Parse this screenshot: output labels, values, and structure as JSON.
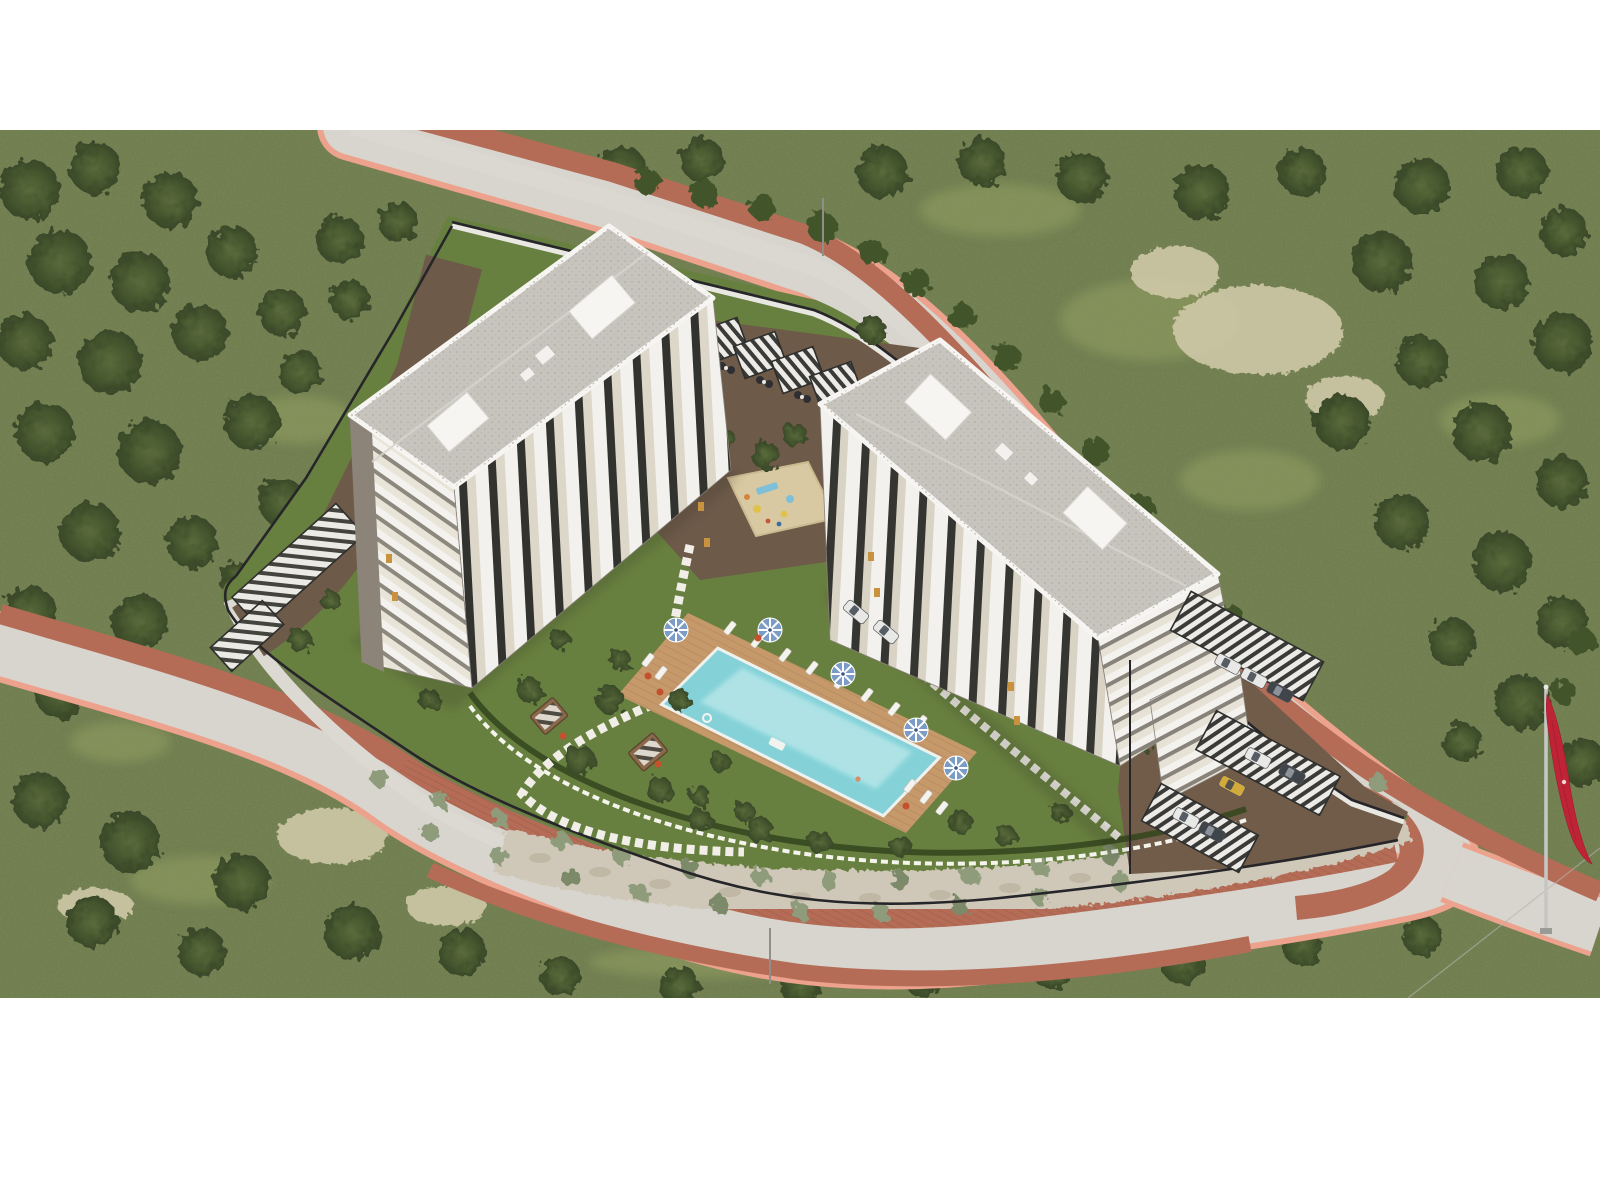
{
  "scene": {
    "kind": "aerial-architectural-render",
    "subject": "two-block residential complex with pool, gardens and parking on a forested hillside",
    "flag": "turkish-red-flag-on-pole",
    "render_area": {
      "top": 130,
      "bottom": 998,
      "left": 0,
      "right": 1600
    }
  },
  "palette": {
    "page_bg": "#ffffff",
    "forest_base": "#6d7b4b",
    "forest_noise": "#3d4a27",
    "grass_light": "#96a263",
    "rock": "#d4cbab",
    "road_surface": "#d8d4ce",
    "road_center": "#e3e0db",
    "sidewalk_salmon": "#eca28c",
    "sidewalk_brick": "#b46c56",
    "stone_band": "#cfc8b9",
    "stone_dot": "#bcb3a0",
    "wall_light": "#dcd9d2",
    "fence_black": "#26262a",
    "fence_white": "#f4f3ec",
    "lawn": "#68803f",
    "hedge": "#36471f",
    "tree_core": "#42552c",
    "mulch": "#6e5a49",
    "parking_dirt": "#705c49",
    "deck": "#c6996b",
    "deck_line": "#b2875c",
    "pool_water": "#84d2d8",
    "pool_light": "#bce8ea",
    "pool_coping": "#eff1ee",
    "sand": "#d9c9a2",
    "roof": "#c7c4be",
    "roof_dot": "#b2afa8",
    "parapet": "#f6f5f2",
    "facade_cream": "#e4dfd3",
    "facade_white": "#f3f1ed",
    "facade_dark": "#32322e",
    "facade_gray": "#8c8379",
    "window_amber": "#c8923f",
    "canopy_slat": "#ecebe7",
    "car_white": "#e8e8e6",
    "car_dark": "#40444b",
    "car_yellow": "#d2a93c",
    "umbrella_blue": "#7b9cc6",
    "flag_red": "#bf2336",
    "pole_gray": "#c6c6c3",
    "shadow": "#2b2b20"
  },
  "forest": {
    "canopies": [
      [
        30,
        190,
        30
      ],
      [
        95,
        168,
        26
      ],
      [
        170,
        200,
        28
      ],
      [
        60,
        262,
        32
      ],
      [
        140,
        282,
        30
      ],
      [
        232,
        252,
        26
      ],
      [
        25,
        342,
        28
      ],
      [
        110,
        362,
        32
      ],
      [
        200,
        332,
        28
      ],
      [
        282,
        312,
        24
      ],
      [
        45,
        432,
        30
      ],
      [
        150,
        452,
        32
      ],
      [
        252,
        422,
        28
      ],
      [
        90,
        532,
        30
      ],
      [
        192,
        542,
        26
      ],
      [
        282,
        502,
        24
      ],
      [
        30,
        612,
        26
      ],
      [
        140,
        622,
        28
      ],
      [
        242,
        582,
        22
      ],
      [
        60,
        692,
        26
      ],
      [
        162,
        702,
        24
      ],
      [
        40,
        800,
        28
      ],
      [
        130,
        842,
        30
      ],
      [
        242,
        882,
        28
      ],
      [
        352,
        932,
        28
      ],
      [
        92,
        922,
        26
      ],
      [
        462,
        952,
        24
      ],
      [
        202,
        952,
        24
      ],
      [
        560,
        976,
        20
      ],
      [
        680,
        986,
        20
      ],
      [
        800,
        986,
        20
      ],
      [
        922,
        976,
        20
      ],
      [
        1052,
        970,
        20
      ],
      [
        1182,
        962,
        22
      ],
      [
        1302,
        946,
        20
      ],
      [
        1422,
        936,
        20
      ],
      [
        520,
        166,
        24
      ],
      [
        622,
        172,
        26
      ],
      [
        702,
        160,
        22
      ],
      [
        882,
        172,
        26
      ],
      [
        982,
        162,
        24
      ],
      [
        1082,
        177,
        26
      ],
      [
        1202,
        192,
        28
      ],
      [
        1302,
        172,
        24
      ],
      [
        1422,
        186,
        28
      ],
      [
        1522,
        172,
        26
      ],
      [
        1564,
        232,
        24
      ],
      [
        1382,
        262,
        30
      ],
      [
        1502,
        282,
        28
      ],
      [
        1562,
        342,
        30
      ],
      [
        1422,
        362,
        26
      ],
      [
        1342,
        422,
        28
      ],
      [
        1482,
        432,
        30
      ],
      [
        1562,
        482,
        26
      ],
      [
        1402,
        522,
        28
      ],
      [
        1502,
        562,
        30
      ],
      [
        1562,
        622,
        26
      ],
      [
        1452,
        642,
        24
      ],
      [
        1522,
        702,
        28
      ],
      [
        1582,
        762,
        24
      ],
      [
        1462,
        742,
        20
      ]
    ],
    "overhang": [
      [
        340,
        240,
        24
      ],
      [
        398,
        222,
        20
      ],
      [
        300,
        372,
        22
      ],
      [
        350,
        300,
        20
      ],
      [
        872,
        330,
        14
      ]
    ],
    "grass": [
      [
        1150,
        320,
        90,
        40
      ],
      [
        1250,
        480,
        70,
        30
      ],
      [
        1000,
        210,
        80,
        26
      ],
      [
        1500,
        420,
        60,
        26
      ],
      [
        300,
        420,
        55,
        24
      ],
      [
        120,
        742,
        50,
        20
      ],
      [
        700,
        962,
        110,
        16
      ],
      [
        200,
        880,
        70,
        24
      ]
    ],
    "rocks": [
      [
        1258,
        330,
        85,
        45
      ],
      [
        1175,
        272,
        45,
        26
      ],
      [
        1345,
        398,
        40,
        22
      ],
      [
        332,
        836,
        55,
        28
      ],
      [
        446,
        906,
        40,
        20
      ],
      [
        96,
        906,
        38,
        18
      ]
    ]
  },
  "roadside": {
    "bushes": [
      [
        648,
        182,
        13
      ],
      [
        704,
        194,
        14
      ],
      [
        762,
        207,
        13
      ],
      [
        822,
        227,
        15
      ],
      [
        872,
        252,
        13
      ],
      [
        916,
        282,
        14
      ],
      [
        962,
        317,
        13
      ],
      [
        1006,
        357,
        14
      ],
      [
        1052,
        402,
        13
      ],
      [
        1096,
        452,
        14
      ],
      [
        1142,
        507,
        13
      ],
      [
        1186,
        562,
        14
      ],
      [
        1230,
        617,
        13
      ],
      [
        1270,
        667,
        12
      ],
      [
        1582,
        642,
        14
      ],
      [
        1564,
        692,
        12
      ]
    ]
  },
  "embankment": {
    "shrubs": [
      [
        380,
        778
      ],
      [
        440,
        800
      ],
      [
        500,
        820
      ],
      [
        560,
        840
      ],
      [
        622,
        856
      ],
      [
        690,
        868
      ],
      [
        760,
        876
      ],
      [
        830,
        881
      ],
      [
        900,
        881
      ],
      [
        970,
        876
      ],
      [
        1040,
        867
      ],
      [
        1110,
        855
      ],
      [
        1180,
        839
      ],
      [
        1250,
        821
      ],
      [
        1320,
        801
      ],
      [
        1378,
        783
      ],
      [
        430,
        832
      ],
      [
        500,
        857
      ],
      [
        570,
        877
      ],
      [
        640,
        893
      ],
      [
        720,
        905
      ],
      [
        800,
        911
      ],
      [
        880,
        911
      ],
      [
        960,
        906
      ],
      [
        1040,
        896
      ],
      [
        1120,
        881
      ],
      [
        1200,
        863
      ],
      [
        1278,
        843
      ]
    ],
    "stones": [
      [
        540,
        858
      ],
      [
        600,
        872
      ],
      [
        660,
        884
      ],
      [
        730,
        892
      ],
      [
        800,
        897
      ],
      [
        870,
        898
      ],
      [
        940,
        895
      ],
      [
        1010,
        888
      ],
      [
        1080,
        878
      ],
      [
        1150,
        864
      ],
      [
        1220,
        848
      ],
      [
        1290,
        830
      ],
      [
        1352,
        812
      ]
    ]
  },
  "garden": {
    "trees": [
      [
        500,
        640,
        16
      ],
      [
        530,
        690,
        13
      ],
      [
        610,
        700,
        14
      ],
      [
        580,
        760,
        15
      ],
      [
        660,
        790,
        13
      ],
      [
        700,
        820,
        12
      ],
      [
        760,
        830,
        13
      ],
      [
        820,
        842,
        12
      ],
      [
        900,
        846,
        11
      ],
      [
        960,
        822,
        12
      ],
      [
        620,
        660,
        11
      ],
      [
        680,
        700,
        11
      ],
      [
        720,
        762,
        10
      ],
      [
        560,
        640,
        10
      ],
      [
        1006,
        836,
        11
      ],
      [
        1060,
        812,
        10
      ],
      [
        982,
        620,
        12
      ],
      [
        1022,
        652,
        11
      ],
      [
        1092,
        702,
        12
      ],
      [
        1140,
        742,
        11
      ],
      [
        700,
        796,
        10
      ],
      [
        745,
        812,
        10
      ],
      [
        470,
        600,
        12
      ],
      [
        445,
        560,
        11
      ],
      [
        765,
        455,
        14
      ],
      [
        795,
        435,
        12
      ],
      [
        725,
        440,
        11
      ],
      [
        300,
        640,
        12
      ],
      [
        330,
        600,
        10
      ],
      [
        430,
        700,
        11
      ]
    ],
    "flowers": [
      [
        648,
        676
      ],
      [
        660,
        692
      ],
      [
        758,
        638
      ],
      [
        906,
        806
      ],
      [
        563,
        736
      ],
      [
        658,
        764
      ],
      [
        867,
        566
      ]
    ]
  },
  "pool": {
    "umbrellas": [
      [
        676,
        630
      ],
      [
        770,
        630
      ],
      [
        843,
        674
      ],
      [
        916,
        730
      ],
      [
        956,
        768
      ]
    ],
    "loungers": [
      [
        730,
        628
      ],
      [
        757,
        641
      ],
      [
        785,
        655
      ],
      [
        812,
        668
      ],
      [
        840,
        682
      ],
      [
        867,
        695
      ],
      [
        894,
        709
      ],
      [
        921,
        722
      ],
      [
        648,
        660
      ],
      [
        661,
        673
      ],
      [
        910,
        786
      ],
      [
        926,
        797
      ],
      [
        942,
        808
      ]
    ]
  },
  "courtyard": {
    "furniture": [
      [
        722,
        352
      ],
      [
        760,
        366
      ],
      [
        798,
        381
      ],
      [
        836,
        396
      ]
    ]
  },
  "parking": {
    "cars": [
      [
        1228,
        664,
        28,
        "w"
      ],
      [
        1254,
        678,
        28,
        "w"
      ],
      [
        1280,
        692,
        28,
        "d"
      ],
      [
        856,
        612,
        40,
        "w"
      ],
      [
        886,
        632,
        40,
        "w"
      ],
      [
        1258,
        758,
        28,
        "w"
      ],
      [
        1292,
        774,
        28,
        "d"
      ],
      [
        1232,
        786,
        28,
        "y"
      ],
      [
        1186,
        818,
        28,
        "w"
      ],
      [
        1212,
        832,
        28,
        "d"
      ]
    ]
  }
}
